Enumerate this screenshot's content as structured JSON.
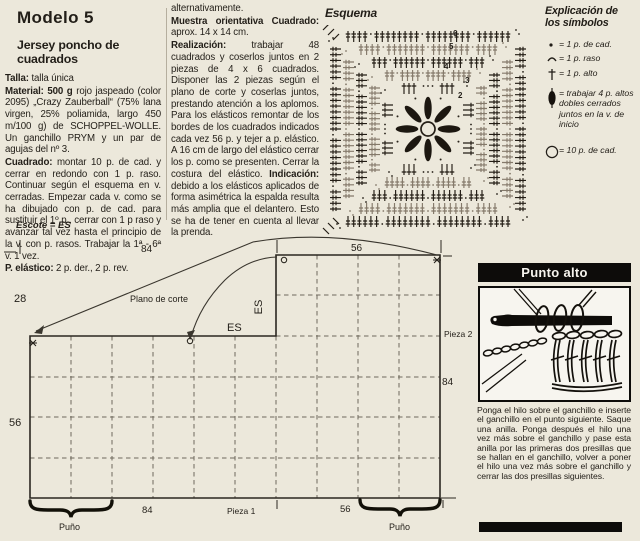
{
  "article": {
    "title": "Modelo 5",
    "subtitle": "Jersey poncho de cuadrados",
    "col1": [
      [
        {
          "t": "Talla:",
          "b": true
        },
        {
          "t": " talla única"
        }
      ],
      [
        {
          "t": "Material: 500 g",
          "b": true
        },
        {
          "t": " rojo jaspeado (color 2095) „Crazy Zauberball“ (75% lana virgen, 25% poliamida, largo 450 m/100 g) de SCHOPPEL-WOLLE. Un ganchillo PRYM y un par de agujas del nº 3."
        }
      ],
      [
        {
          "t": "Cuadrado:",
          "b": true
        },
        {
          "t": " montar 10 p. de cad. y cerrar en redondo con 1 p. raso. Continuar según el esquema en v. cerradas. Empezar cada v. como se ha dibujado con p. de cad. para sustituir el 1º p., cerrar con 1 p raso y avanzar tal vez hasta el principio de la v. con p. rasos. Trabajar la 1ª - 6ª v. 1 vez."
        }
      ],
      [
        {
          "t": "P. elástico:",
          "b": true
        },
        {
          "t": " 2 p. der., 2 p. rev."
        }
      ]
    ],
    "col2": [
      [
        {
          "t": "alternativamente."
        }
      ],
      [
        {
          "t": "Muestra orientativa Cuadrado:",
          "b": true
        },
        {
          "t": " aprox. 14 x 14 cm."
        }
      ],
      [
        {
          "t": "Realización:",
          "b": true
        },
        {
          "t": " trabajar 48 cuadrados y coserlos juntos en 2 piezas de 4 x 6 cuadrados. Disponer las 2 piezas según el plano de corte y coserlas juntos, prestando atención a los aplomos. Para los elásticos remontar de los bordes de los cuadrados indicados cada vez 56 p. y tejer a p. elástico. A 16 cm de largo del elástico cerrar los p. como se presenten. Cerrar la costura del elástico. "
        },
        {
          "t": "Indicación:",
          "b": true
        },
        {
          "t": " debido a los elásticos aplicados de forma asimétrica la espalda resulta más amplia que el delantero. Esto se ha de tener en cuenta al llevar la prenda."
        }
      ]
    ]
  },
  "esquema": {
    "title": "Esquema",
    "round_numbers": [
      "2",
      "3",
      "4",
      "5",
      "6"
    ]
  },
  "legend": {
    "title1": "Explicación de",
    "title2": "los símbolos",
    "items": [
      {
        "icon": "chain-stitch-dot-icon",
        "label": "= 1 p. de cad."
      },
      {
        "icon": "slip-stitch-icon",
        "label": "= 1 p. raso"
      },
      {
        "icon": "double-crochet-cross-icon",
        "label": "= 1 p. alto"
      },
      {
        "icon": "puff-stitch-icon",
        "label": "= trabajar 4 p. altos dobles cerrados juntos en la v. de inicio"
      },
      {
        "icon": "chain-ring-icon",
        "label": "= 10 p. de cad."
      }
    ]
  },
  "schematic": {
    "escote": "Escote = ES",
    "top_84": "84",
    "left_28": "28",
    "plano_de_corte": "Plano de corte",
    "es_horizontal": "ES",
    "es_vertical": "ES",
    "top_56": "56",
    "pieza2": "Pieza 2",
    "right_84": "84",
    "left_56": "56",
    "puno_left": "Puño",
    "bottom_84": "84",
    "pieza1": "Pieza 1",
    "bottom_56": "56",
    "puno_right": "Puño"
  },
  "punto_alto": {
    "title": "Punto alto",
    "body": "Ponga el hilo sobre el ganchillo e inserte el ganchillo en el punto siguiente. Saque una anilla. Ponga después el hilo una vez más sobre el ganchillo y pase esta anilla por las primeras dos presillas que se hallan en el ganchillo, volver a poner el hilo una vez más sobre el ganchillo y cerrar las dos presillas siguientes."
  }
}
